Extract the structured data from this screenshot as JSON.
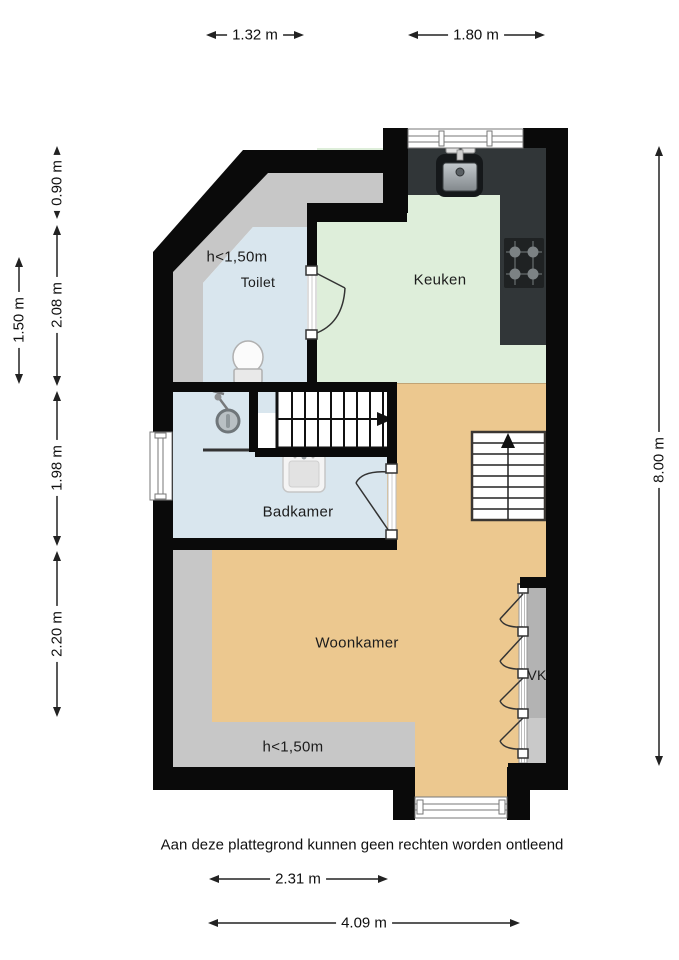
{
  "plan": {
    "disclaimer": "Aan deze plattegrond kunnen geen rechten worden ontleend",
    "rooms": {
      "toilet": {
        "label": "Toilet",
        "height_note": "h<1,50m"
      },
      "keuken": {
        "label": "Keuken"
      },
      "badkamer": {
        "label": "Badkamer"
      },
      "woonkamer": {
        "label": "Woonkamer",
        "height_note": "h<1,50m"
      },
      "vk": {
        "label": "VK"
      }
    },
    "dimensions": {
      "top": [
        {
          "label": "1.32 m"
        },
        {
          "label": "1.80 m"
        }
      ],
      "left": [
        {
          "label": "0.90 m"
        },
        {
          "label": "2.08 m"
        },
        {
          "label": "1.50 m"
        },
        {
          "label": "1.98 m"
        },
        {
          "label": "2.20 m"
        }
      ],
      "right": [
        {
          "label": "8.00 m"
        }
      ],
      "bottom": [
        {
          "label": "2.31 m"
        },
        {
          "label": "4.09 m"
        }
      ]
    },
    "colors": {
      "wall": "#0a0a0a",
      "wet_room_floor": "#d9e6ee",
      "keuken_floor": "#deeeda",
      "woonkamer_floor": "#ecc88f",
      "low_height_zone": "#c7c7c7",
      "counter": "#313638",
      "closet_interior": "#b3b3b3"
    }
  }
}
